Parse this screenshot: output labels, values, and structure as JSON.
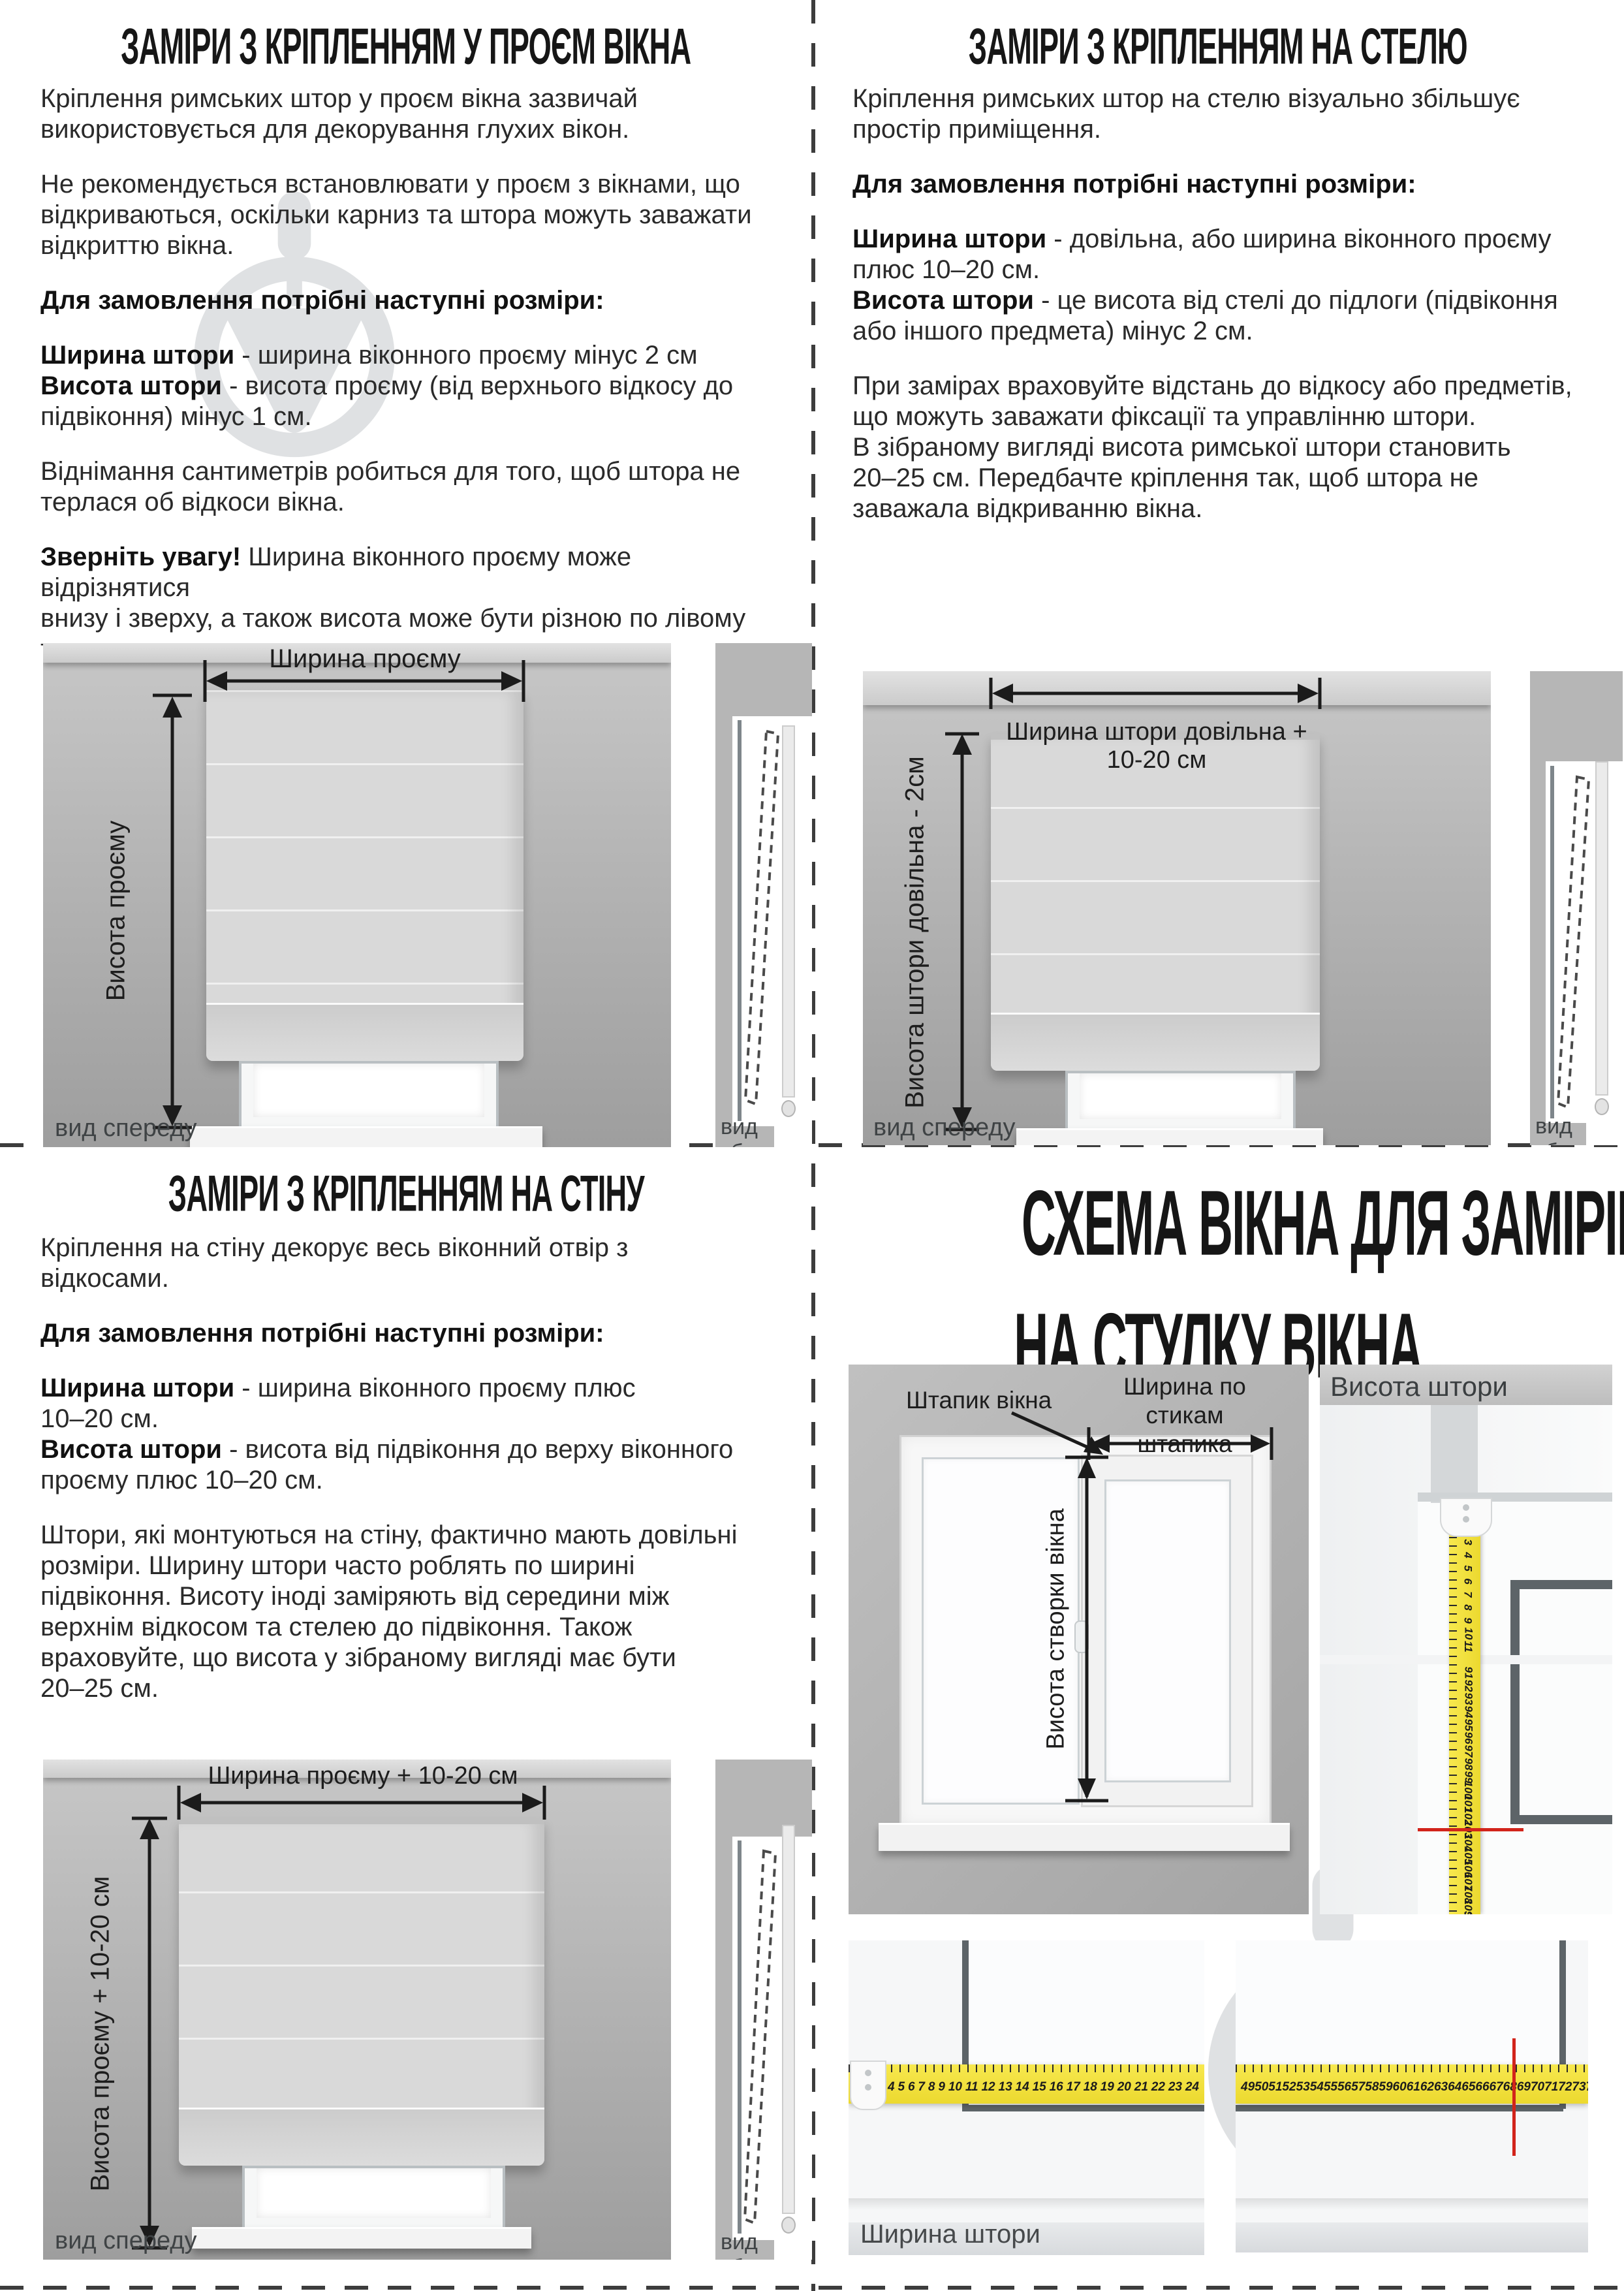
{
  "q1": {
    "title": "ЗАМІРИ З КРІПЛЕННЯМ У ПРОЄМ ВІКНА",
    "p1": [
      {
        "t": "Кріплення римських штор у проєм вікна зазвичай"
      },
      {
        "br": true
      },
      {
        "t": "використовується для декорування глухих вікон."
      }
    ],
    "p2": [
      {
        "t": "Не рекомендується встановлювати у проєм з вікнами, що"
      },
      {
        "br": true
      },
      {
        "t": "відкриваються, оскільки карниз та штора можуть заважати"
      },
      {
        "br": true
      },
      {
        "t": "відкриттю вікна."
      }
    ],
    "p3": [
      {
        "b": true,
        "t": "Для замовлення потрібні наступні розміри:"
      }
    ],
    "p4": [
      {
        "b": true,
        "t": "Ширина штори"
      },
      {
        "t": " - ширина віконного проєму мінус 2 см"
      },
      {
        "br": true
      },
      {
        "b": true,
        "t": "Висота штори"
      },
      {
        "t": " - висота проєму (від верхнього відкосу до"
      },
      {
        "br": true
      },
      {
        "t": "підвіконня) мінус 1 см."
      }
    ],
    "p5": [
      {
        "t": "Віднімання сантиметрів робиться для того, щоб штора не"
      },
      {
        "br": true
      },
      {
        "t": "терлася об відкоси вікна."
      }
    ],
    "p6": [
      {
        "b": true,
        "t": "Зверніть увагу!"
      },
      {
        "t": " Ширина віконного проєму може відрізнятися"
      },
      {
        "br": true
      },
      {
        "t": "внизу і зверху, а також висота може бути різною по лівому"
      },
      {
        "br": true
      },
      {
        "t": "та правому краях проєму."
      }
    ],
    "front": {
      "width_label": "Ширина проєму",
      "height_label": "Висота проєму",
      "view": "вид спереду"
    },
    "side": {
      "view": "вид збоку"
    }
  },
  "q2": {
    "title": "ЗАМІРИ З КРІПЛЕННЯМ НА СТЕЛЮ",
    "p1": [
      {
        "t": "Кріплення римських штор на стелю візуально збільшує"
      },
      {
        "br": true
      },
      {
        "t": "простір приміщення."
      }
    ],
    "p2": [
      {
        "b": true,
        "t": "Для замовлення потрібні наступні розміри:"
      }
    ],
    "p3": [
      {
        "b": true,
        "t": "Ширина штори"
      },
      {
        "t": " - довільна, або ширина віконного проєму"
      },
      {
        "br": true
      },
      {
        "t": "плюс 10–20 см."
      },
      {
        "br": true
      },
      {
        "b": true,
        "t": "Висота штори"
      },
      {
        "t": " - це висота від стелі до підлоги (підвіконня"
      },
      {
        "br": true
      },
      {
        "t": "або іншого предмета) мінус 2 см."
      }
    ],
    "p4": [
      {
        "t": "При замірах враховуйте відстань до відкосу або предметів,"
      },
      {
        "br": true
      },
      {
        "t": "що можуть заважати фіксації та управлінню штори."
      },
      {
        "br": true
      },
      {
        "t": "В зібраному вигляді висота римської штори становить"
      },
      {
        "br": true
      },
      {
        "t": "20–25 см. Передбачте кріплення так, щоб штора не"
      },
      {
        "br": true
      },
      {
        "t": "заважала відкриванню вікна."
      }
    ],
    "front": {
      "width_label": "Ширина штори довільна + 10-20 см",
      "height_label": "Висота штори довільна - 2см",
      "view": "вид спереду"
    },
    "side": {
      "view": "вид збоку"
    }
  },
  "q3": {
    "title": "ЗАМІРИ З КРІПЛЕННЯМ НА СТІНУ",
    "p1": [
      {
        "t": "Кріплення на стіну декорує весь віконний отвір з"
      },
      {
        "br": true
      },
      {
        "t": "відкосами."
      }
    ],
    "p2": [
      {
        "b": true,
        "t": "Для замовлення потрібні наступні розміри:"
      }
    ],
    "p3": [
      {
        "b": true,
        "t": "Ширина штори"
      },
      {
        "t": " - ширина віконного проєму плюс"
      },
      {
        "br": true
      },
      {
        "t": "10–20 см."
      },
      {
        "br": true
      },
      {
        "b": true,
        "t": "Висота штори"
      },
      {
        "t": " - висота від підвіконня до верху віконного"
      },
      {
        "br": true
      },
      {
        "t": "проєму плюс 10–20 см."
      }
    ],
    "p4": [
      {
        "t": "Штори, які монтуються на стіну, фактично мають довільні"
      },
      {
        "br": true
      },
      {
        "t": "розміри. Ширину штори часто роблять по ширині"
      },
      {
        "br": true
      },
      {
        "t": "підвіконня. Висоту іноді заміряють від середини між"
      },
      {
        "br": true
      },
      {
        "t": "верхнім відкосом та стелею до підвіконня. Також"
      },
      {
        "br": true
      },
      {
        "t": "враховуйте, що висота у зібраному вигляді має бути"
      },
      {
        "br": true
      },
      {
        "t": "20–25 см."
      }
    ],
    "front": {
      "width_label": "Ширина проєму + 10-20 см",
      "height_label": "Висота проєму + 10-20 см",
      "view": "вид спереду"
    },
    "side": {
      "view": "вид збоку"
    }
  },
  "q4": {
    "title_line1": "СХЕМА ВІКНА ДЛЯ ЗАМІРІВ",
    "title_line2": "НА СТУЛКУ ВІКНА",
    "diagram": {
      "bead_label": "Штапик вікна",
      "width_label_1": "Ширина по стикам",
      "width_label_2": "штапика",
      "sash_height_label": "Висота створки вікна"
    },
    "height_photo": {
      "label": "Висота штори",
      "numbers_top": [
        "3",
        "4",
        "5",
        "6",
        "7",
        "8",
        "9",
        "10",
        "11"
      ],
      "numbers_bottom": [
        "91",
        "92",
        "93",
        "94",
        "95",
        "96",
        "97",
        "98",
        "99",
        "100",
        "101",
        "102",
        "103",
        "104",
        "105",
        "106",
        "107",
        "108",
        "109",
        "110"
      ]
    },
    "width_photo": {
      "label": "Ширина штори",
      "numbers_left": [
        "4",
        "5",
        "6",
        "7",
        "8",
        "9",
        "10",
        "11",
        "12",
        "13",
        "14",
        "15",
        "16",
        "17",
        "18",
        "19",
        "20",
        "21",
        "22",
        "23",
        "24"
      ],
      "numbers_right": [
        "49",
        "50",
        "51",
        "52",
        "53",
        "54",
        "55",
        "56",
        "57",
        "58",
        "59",
        "60",
        "61",
        "62",
        "63",
        "64",
        "65",
        "66",
        "67",
        "68",
        "69",
        "70",
        "71",
        "72",
        "73",
        "74",
        "75",
        "76",
        "77",
        "78",
        "79"
      ]
    }
  },
  "colors": {
    "tape_yellow": "#ecd92f",
    "red_mark": "#d2241b",
    "watermark_gray": "#cdd0d2",
    "wall_gray": "#b4b4b4",
    "text": "#232323"
  }
}
